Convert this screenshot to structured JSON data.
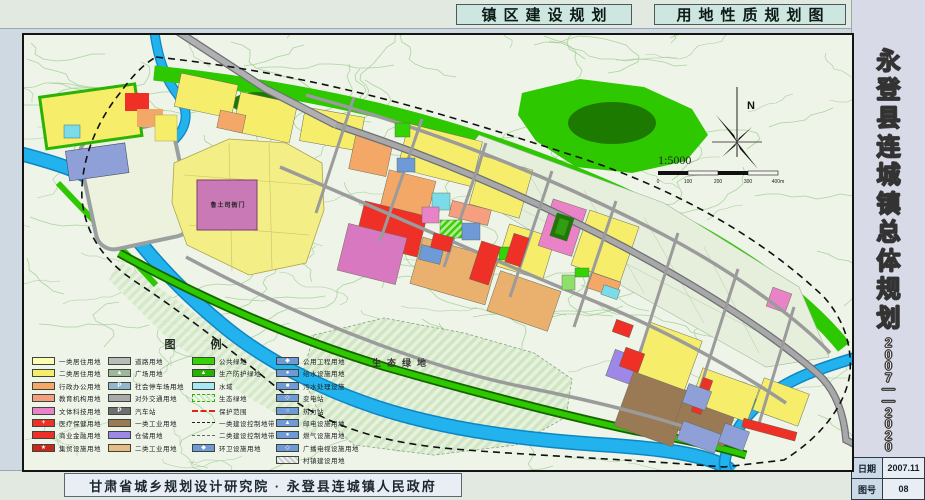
{
  "header": {
    "tabs": [
      {
        "label": "镇区建设规划"
      },
      {
        "label": "用地性质规划图"
      }
    ]
  },
  "sidebar": {
    "title": "永登县连城镇总体规划",
    "period": "2007——2020",
    "title_block": {
      "rows": [
        {
          "label": "日期",
          "value": "2007.11"
        },
        {
          "label": "图号",
          "value": "08"
        }
      ]
    }
  },
  "footer": {
    "credit": "甘肃省城乡规划设计研究院 · 永登县连城镇人民政府"
  },
  "map": {
    "labels": {
      "eco": "生态绿地",
      "heritage": "鲁土司衙门"
    },
    "compass": {
      "north": "N",
      "scale": "1:5000",
      "ticks": [
        "0",
        "100",
        "200",
        "300",
        "400m"
      ]
    },
    "legend": {
      "title": "图 例",
      "columns": [
        {
          "items": [
            {
              "type": "fill",
              "color": "#fffdb4",
              "label": "一类居住用地"
            },
            {
              "type": "fill",
              "color": "#f6ee6b",
              "label": "二类居住用地"
            },
            {
              "type": "fill",
              "color": "#f3a868",
              "label": "行政办公用地"
            },
            {
              "type": "fill",
              "color": "#f59f80",
              "label": "教育机构用地"
            },
            {
              "type": "fill",
              "color": "#ea82c8",
              "label": "文体科技用地"
            },
            {
              "type": "symbol",
              "color": "#ee3026",
              "glyph": "+",
              "label": "医疗保健用地"
            },
            {
              "type": "fill",
              "color": "#ee3026",
              "label": "商业金融用地"
            },
            {
              "type": "symbol",
              "color": "#c9281c",
              "glyph": "★",
              "label": "集贸设施用地"
            }
          ]
        },
        {
          "items": [
            {
              "type": "fill",
              "color": "#b9bdb9",
              "label": "道路用地"
            },
            {
              "type": "symbol",
              "color": "#9fb79a",
              "glyph": "▲",
              "label": "广场用地"
            },
            {
              "type": "symbol",
              "color": "#93b7cd",
              "glyph": "P",
              "label": "社会停车场用地"
            },
            {
              "type": "fill",
              "color": "#a9a9a9",
              "label": "对外交通用地"
            },
            {
              "type": "symbol",
              "color": "#6f6f6f",
              "glyph": "P",
              "label": "汽车站"
            },
            {
              "type": "fill",
              "color": "#9a7a55",
              "label": "一类工业用地"
            },
            {
              "type": "fill",
              "color": "#9d87e9",
              "label": "仓储用地"
            },
            {
              "type": "fill",
              "color": "#e7bd85",
              "label": "二类工业用地"
            }
          ]
        },
        {
          "items": [
            {
              "type": "fill",
              "color": "#35d303",
              "label": "公共绿地"
            },
            {
              "type": "symbol",
              "color": "#28b303",
              "glyph": "▲",
              "label": "生产防护绿地"
            },
            {
              "type": "fill",
              "color": "#a8e8f3",
              "label": "水域"
            },
            {
              "type": "hatch-green",
              "label": "生态绿地"
            },
            {
              "type": "line-red",
              "label": "保护范围"
            },
            {
              "type": "line-dashdot",
              "label": "一类建设控制地带"
            },
            {
              "type": "line-dash",
              "label": "二类建设控制地带"
            },
            {
              "type": "symbol",
              "color": "#6f9ad8",
              "glyph": "◆",
              "label": "环卫设施用地"
            }
          ]
        },
        {
          "items": [
            {
              "type": "symbol",
              "color": "#6f9ad8",
              "glyph": "◆",
              "label": "公用工程用地"
            },
            {
              "type": "symbol",
              "color": "#6f9ad8",
              "glyph": "●",
              "label": "给水设施用地"
            },
            {
              "type": "symbol",
              "color": "#6f9ad8",
              "glyph": "■",
              "label": "污水处理设施"
            },
            {
              "type": "symbol",
              "color": "#6f9ad8",
              "glyph": "◇",
              "label": "变电站"
            },
            {
              "type": "symbol",
              "color": "#6f9ad8",
              "glyph": "○",
              "label": "热力站"
            },
            {
              "type": "symbol",
              "color": "#6f9ad8",
              "glyph": "▲",
              "label": "邮电设施用地"
            },
            {
              "type": "symbol",
              "color": "#6f9ad8",
              "glyph": "●",
              "label": "燃气设施用地"
            },
            {
              "type": "symbol",
              "color": "#6f9ad8",
              "glyph": "◇",
              "label": "广播电视设施用地"
            },
            {
              "type": "hatch-gray",
              "label": "村镇建设用地"
            }
          ]
        }
      ]
    }
  },
  "colors": {
    "water": "#22b2ee",
    "public_green": "#2ec800",
    "residential_yellow": "#f6ee6b",
    "commercial_red": "#ee3026",
    "heritage_pink": "#c97ab6",
    "road_gray": "#9b9b9b"
  }
}
